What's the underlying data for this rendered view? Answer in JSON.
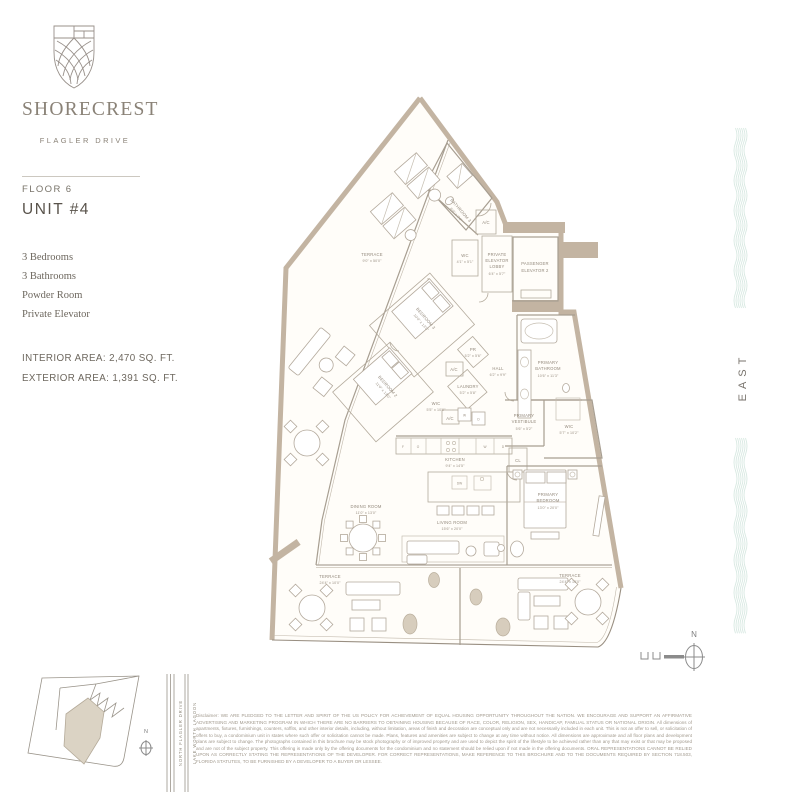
{
  "brand": {
    "name": "SHORECREST",
    "tagline": "FLAGLER DRIVE"
  },
  "unit": {
    "floor_label": "FLOOR 6",
    "unit_label": "UNIT #4",
    "features": [
      "3 Bedrooms",
      "3 Bathrooms",
      "Powder Room",
      "Private Elevator"
    ],
    "interior_area": "INTERIOR AREA: 2,470 SQ. FT.",
    "exterior_area": "EXTERIOR AREA: 1,391 SQ. FT."
  },
  "side": {
    "east": "EAST"
  },
  "compass": {
    "n": "N"
  },
  "siteplan": {
    "n": "N",
    "streets": [
      "NORTH FLAGLER DRIVE",
      "LAKE WORTH LAGOON"
    ]
  },
  "plan": {
    "rooms": {
      "terrace_left": {
        "l1": "TERRACE",
        "dims": "9'0\" x 50'0\""
      },
      "bathroom3": {
        "l1": "BATHROOM 3",
        "dims": "6'0\" x 7'4\""
      },
      "ac": {
        "l1": "A/C"
      },
      "wc": {
        "l1": "WC",
        "dims": "4'1\" x 5'1\""
      },
      "private_lobby": {
        "l1": "PRIVATE",
        "l2": "ELEVATOR",
        "l3": "LOBBY",
        "dims": "6'4\" x 5'7\""
      },
      "passenger": {
        "l1": "PASSENGER",
        "l2": "ELEVATOR 2"
      },
      "bedroom3": {
        "l1": "BEDROOM 3",
        "dims": "10'0\" x 13'0\""
      },
      "bedroom2": {
        "l1": "BEDROOM 2",
        "dims": "11'0\" x 13'0\""
      },
      "pr": {
        "l1": "PR",
        "dims": "5'2\" x 5'6\""
      },
      "laundry": {
        "l1": "LAUNDRY",
        "dims": "5'2\" x 5'8\""
      },
      "wic": {
        "l1": "WIC",
        "dims": "5'5\" x 10'0\""
      },
      "hall": {
        "l1": "HALL",
        "dims": "6'2\" x 9'9\""
      },
      "primary_bath": {
        "l1": "PRIMARY",
        "l2": "BATHROOM",
        "dims": "10'6\" x 11'3\""
      },
      "primary_vest": {
        "l1": "PRIMARY",
        "l2": "VESTIBULE",
        "dims": "5'6\" x 5'2\""
      },
      "wic_primary": {
        "l1": "WIC",
        "dims": "5'7\" x 10'2\""
      },
      "cl": {
        "l1": "CL"
      },
      "kitchen": {
        "l1": "KITCHEN",
        "dims": "9'4\" x 14'5\""
      },
      "living": {
        "l1": "LIVING ROOM",
        "dims": "15'6\" x 20'0\""
      },
      "dining": {
        "l1": "DINING ROOM",
        "dims": "11'0\" x 13'0\""
      },
      "primary_bed": {
        "l1": "PRIMARY",
        "l2": "BEDROOM",
        "dims": "13'0\" x 20'0\""
      },
      "terrace_bl": {
        "l1": "TERRACE",
        "dims": "24'4\" x 10'0\""
      },
      "terrace_br": {
        "l1": "TERRACE",
        "dims": "24'4\" x 10'0\""
      }
    },
    "appliances": {
      "f": "F",
      "o": "O",
      "w": "W",
      "d": "D",
      "dw": "DW"
    }
  },
  "disclaimer": "Disclaimer: WE ARE PLEDGED TO THE LETTER AND SPIRIT OF THE US POLICY FOR ACHIEVEMENT OF EQUAL HOUSING OPPORTUNITY THROUGHOUT THE NATION. WE ENCOURAGE AND SUPPORT AN AFFIRMATIVE ADVERTISING AND MARKETING PROGRAM IN WHICH THERE ARE NO BARRIERS TO OBTAINING HOUSING BECAUSE OF RACE, COLOR, RELIGION, SEX, HANDICAP, FAMILIAL STATUS OR NATIONAL ORIGIN. All dimensions of apartments, fixtures, furnishings, counters, soffits, and other interior details, including, without limitation, areas of finish and decoration are conceptual only and are not necessarily included in each unit. This is not an offer to sell, or solicitation of offers to buy, a condominium unit in states where such offer or solicitation cannot be made. Plans, features and amenities are subject to change at any time without notice. All dimensions are approximate and all floor plans and development plans are subject to change. The photographs contained in this brochure may be stock photography or of improved property and are used to depict the spirit of the lifestyle to be achieved rather than any that may exist or that may be proposed and are not of the subject property. This offering is made only by the offering documents for the condominium and no statement should be relied upon if not made in the offering documents. ORAL REPRESENTATIONS CANNOT BE RELIED UPON AS CORRECTLY STATING THE REPRESENTATIONS OF THE DEVELOPER. FOR CORRECT REPRESENTATIONS, MAKE REFERENCE TO THIS BROCHURE AND TO THE DOCUMENTS REQUIRED BY SECTION 718.503, FLORIDA STATUTES, TO BE FURNISHED BY A DEVELOPER TO A BUYER OR LESSEE."
}
